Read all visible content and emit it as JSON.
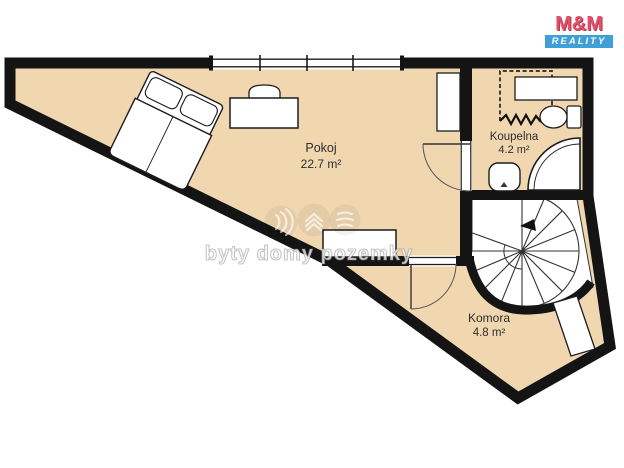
{
  "title": "Byt - půdorys podlaží (floor plan)",
  "colors": {
    "floor": "#f0d7b0",
    "wall": "#141414",
    "furniture_fill": "#ffffff",
    "outline_thin": "#1c1c1c",
    "logo_red": "#e0516a",
    "logo_blue": "#3fa0d8",
    "label_text": "#2e2e2e"
  },
  "rooms": [
    {
      "name": "Pokoj",
      "area": "22.7 m²"
    },
    {
      "name": "Koupelna",
      "area": "4.2 m²"
    },
    {
      "name": "Komora",
      "area": "4.8 m²"
    }
  ],
  "fixtures": [
    "double-bed",
    "desk",
    "chair",
    "wardrobe",
    "low-cabinet",
    "bathroom-cabinet",
    "toilet",
    "corner-shower",
    "sink",
    "spiral-staircase",
    "interior-door-koupelna",
    "interior-door-komora",
    "window-band",
    "sloped-ceiling-dashed-line",
    "storage-shelf"
  ],
  "logo": {
    "name": "M&M",
    "tagline": "REALITY"
  },
  "watermark": {
    "text": "byty domy pozemky",
    "icons": [
      "sound-waves-icon",
      "roof-chevrons-icon",
      "layered-lines-icon"
    ]
  }
}
